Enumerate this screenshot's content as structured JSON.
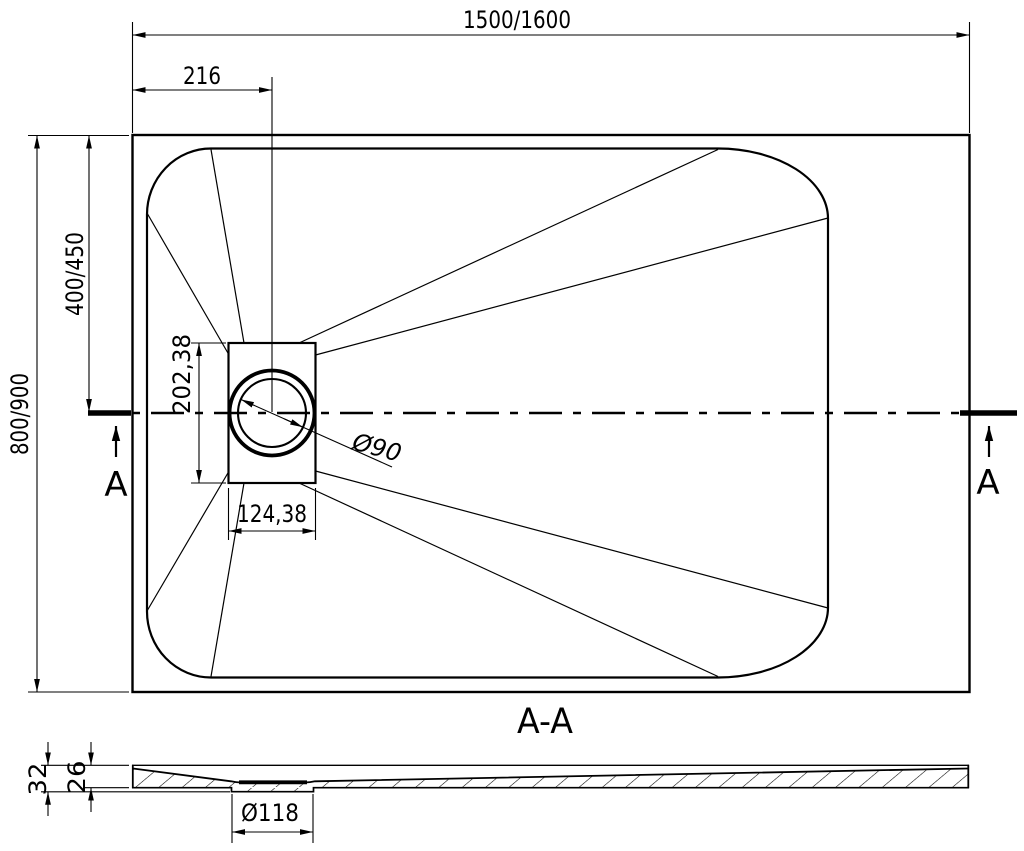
{
  "colors": {
    "ink": "#000000",
    "paper": "#ffffff"
  },
  "top_view": {
    "dim_length": "1500/1600",
    "dim_drain_offset": "216",
    "dim_width": "800/900",
    "dim_half_width": "400/450",
    "dim_recess_height": "202,38",
    "dim_recess_width": "124,38",
    "dim_drain_diameter": "Ø90",
    "section_label_left": "A",
    "section_label_right": "A"
  },
  "section_view": {
    "title": "A-A",
    "dim_total_height": "32",
    "dim_base_height": "26",
    "dim_drain_recess_diameter": "Ø118"
  }
}
